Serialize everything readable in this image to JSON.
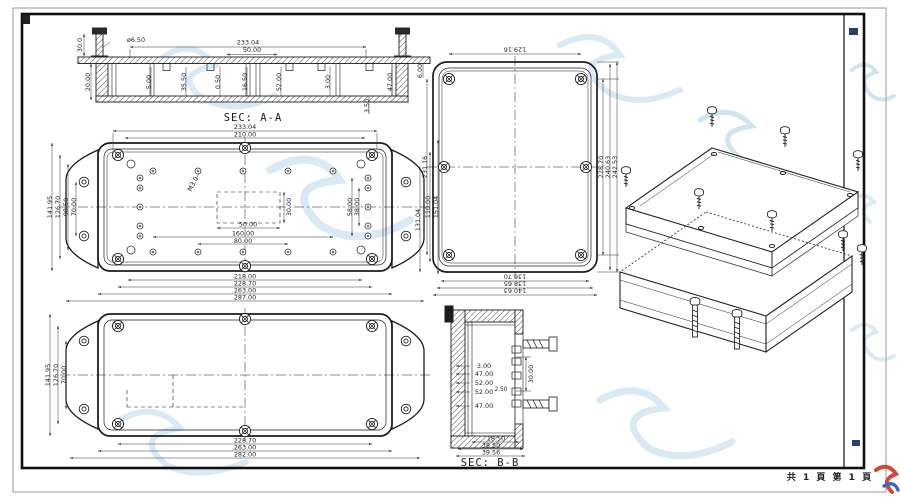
{
  "frame": {
    "page_note": "共 1 頁  第 1 頁"
  },
  "sec_aa": {
    "label": "SEC: A-A",
    "dia": "ø6.50",
    "d30": "30.0",
    "d233": "233.04",
    "d50": "50.00",
    "d20": "20.00",
    "d5": "5.00",
    "d3550": "35.50",
    "d050": "0.50",
    "d1650": "16.50",
    "d52": "52.00",
    "d3": "3.00",
    "d350": "3.50",
    "d47": "47.00",
    "d6": "6.00"
  },
  "plan": {
    "thread_label": "M3.0",
    "top": [
      "233.04",
      "210.00"
    ],
    "bottom": [
      "218.00",
      "228.70",
      "263.00",
      "287.00"
    ],
    "left": [
      "141.95",
      "126.70",
      "98.50",
      "70.00"
    ],
    "right": [
      "110.00",
      "151.04"
    ],
    "inner_right": [
      "58.00",
      "38.00"
    ],
    "pocket": [
      "50.00",
      "30.00"
    ],
    "holes": [
      "160.00",
      "80.00"
    ]
  },
  "back": {
    "left": [
      "141.95",
      "126.70",
      "70.00"
    ],
    "bottom": [
      "228.70",
      "263.00",
      "282.00"
    ]
  },
  "lid": {
    "top": "129.16",
    "left": [
      "231.16",
      "131.04"
    ],
    "right": [
      "228.70",
      "240.63",
      "242.53"
    ],
    "bottom": [
      "136.70",
      "138.65",
      "140.63"
    ]
  },
  "sec_bb": {
    "label": "SEC: B-B",
    "side": [
      "3.00",
      "47.00",
      "52.00",
      "52.00",
      "47.00"
    ],
    "d250": "2.50",
    "d30": "30.00",
    "bottom": [
      "18.50",
      "38.50",
      "39.56"
    ]
  }
}
